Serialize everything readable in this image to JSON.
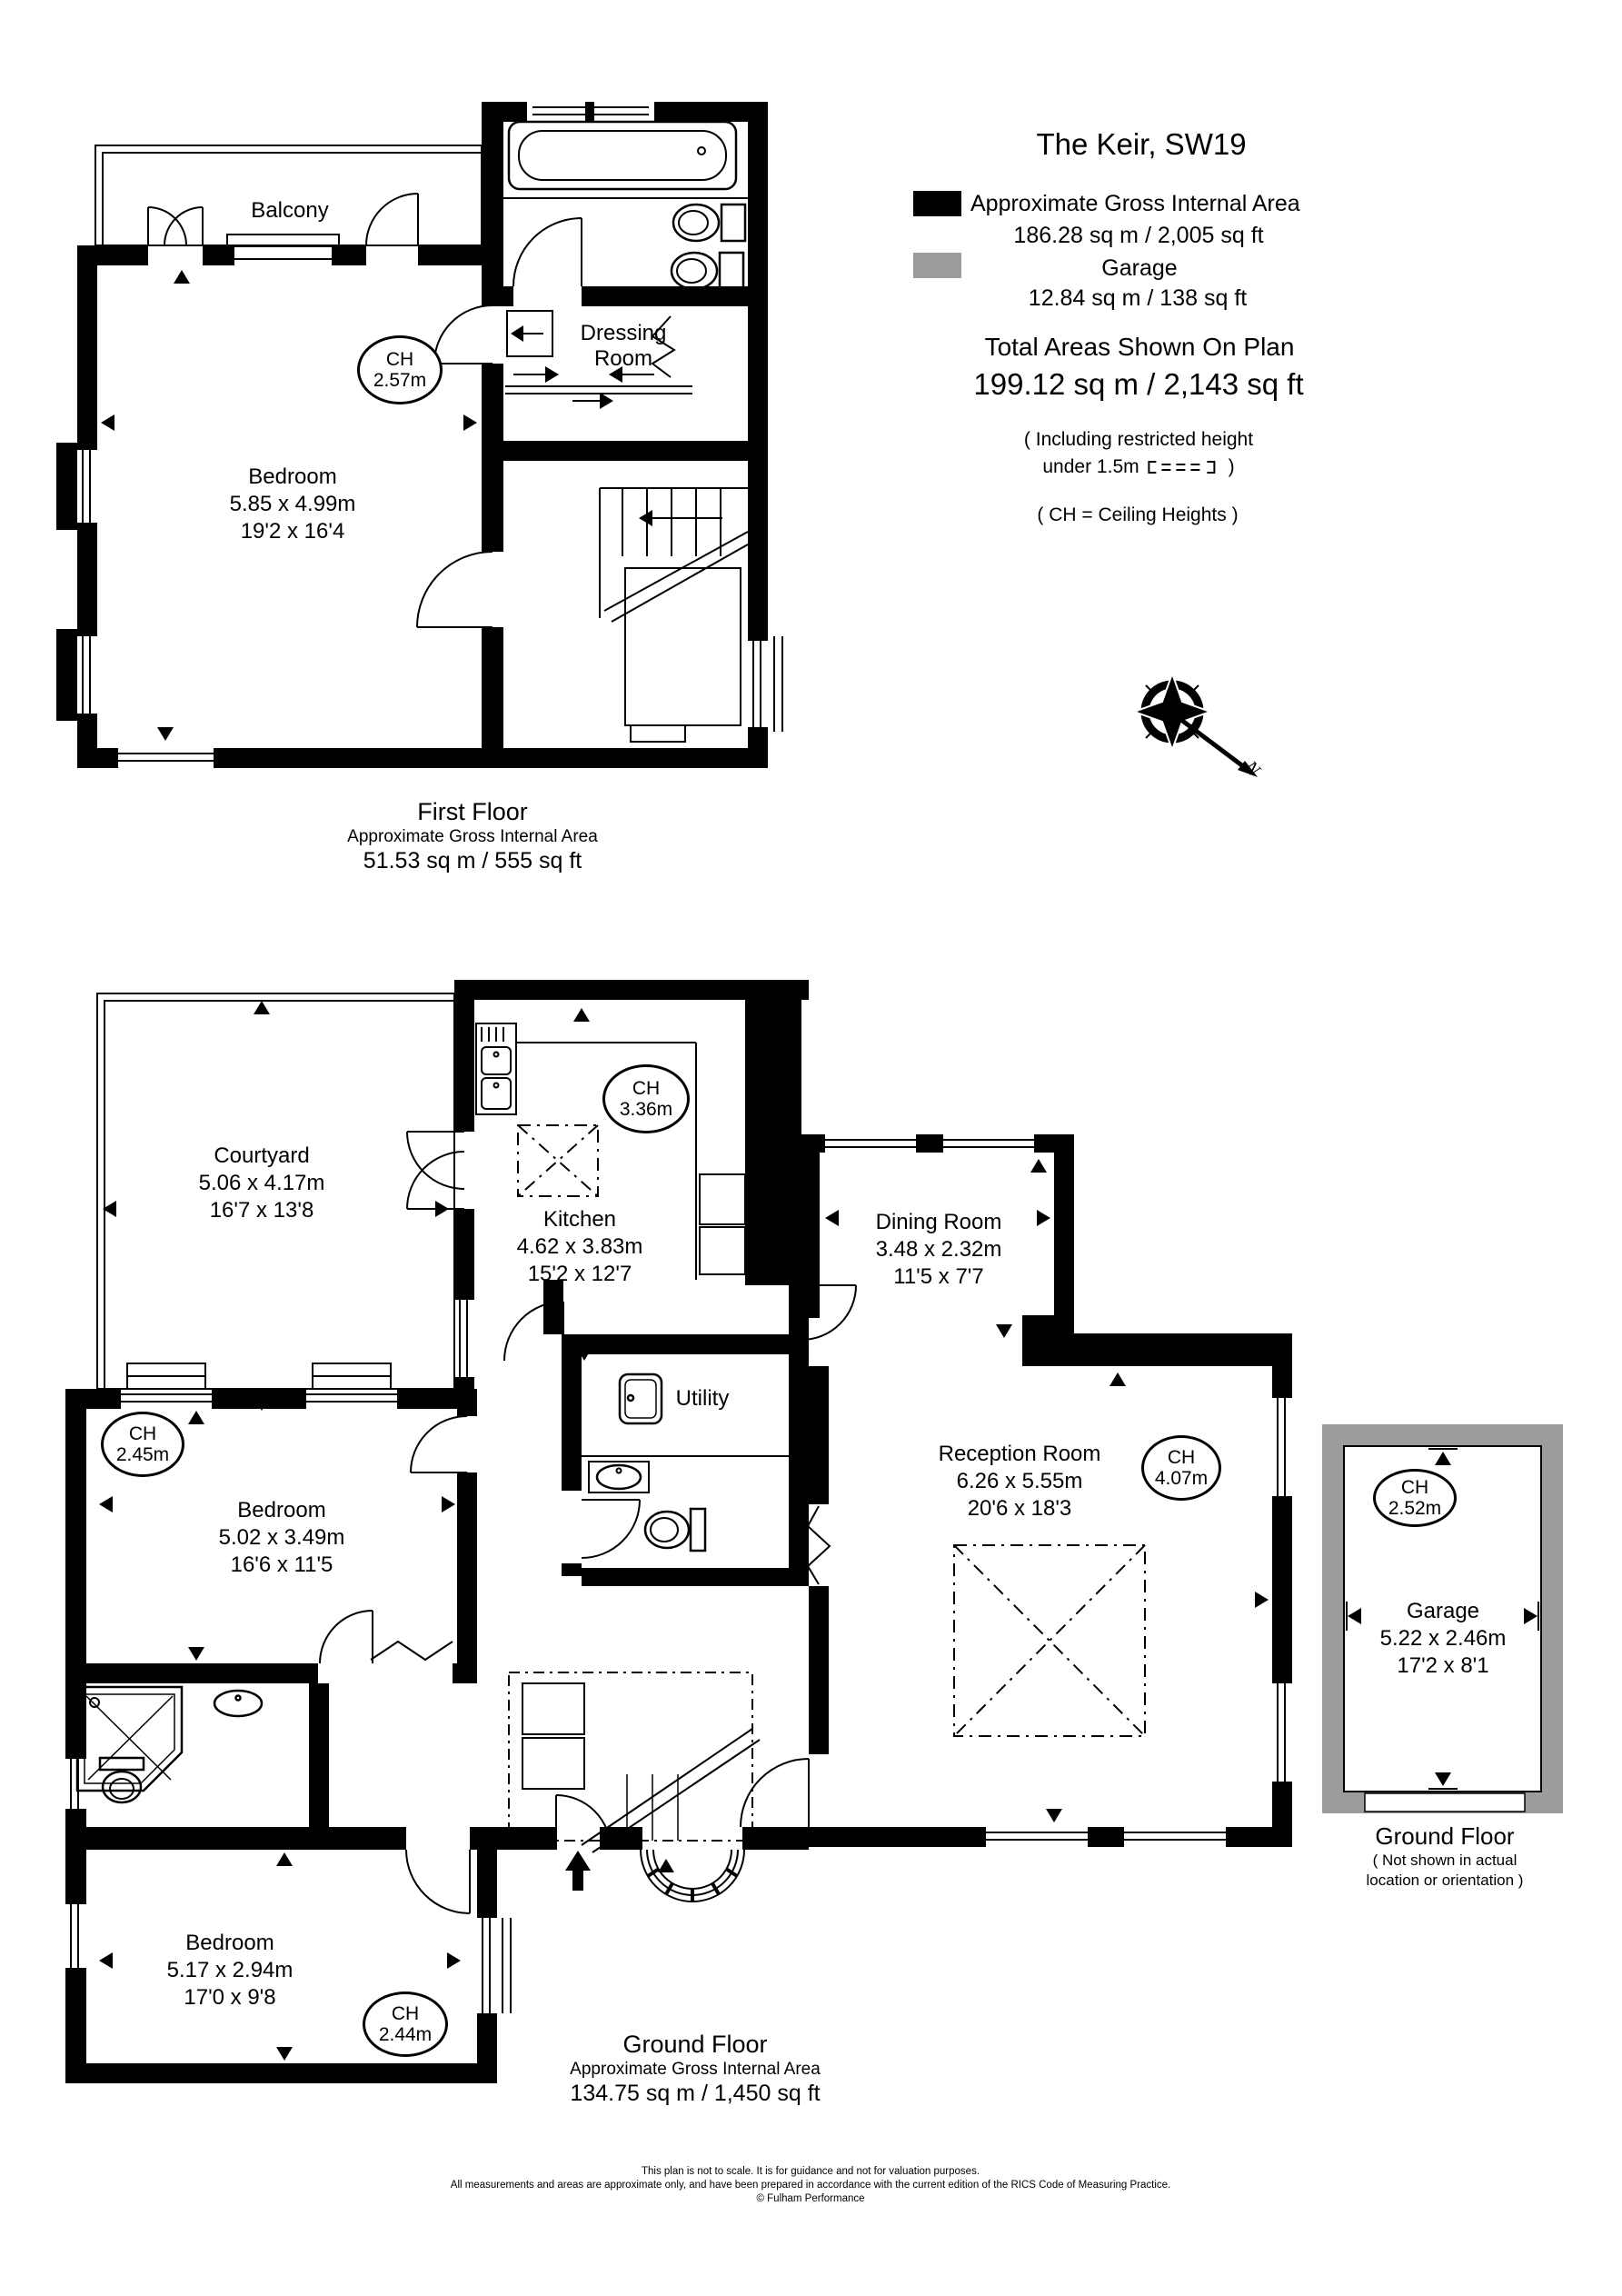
{
  "title": "The Keir, SW19",
  "legend": {
    "internal_color": "#000000",
    "garage_color": "#9c9c9c",
    "internal_label": "Approximate Gross Internal Area",
    "internal_value": "186.28 sq m  /  2,005 sq ft",
    "garage_label": "Garage",
    "garage_value": "12.84 sq m  /  138 sq ft"
  },
  "totals": {
    "label": "Total Areas Shown On Plan",
    "value": "199.12 sq m  /  2,143 sq ft",
    "restricted_line1": "( Including restricted height",
    "restricted_line2_text": "under 1.5m",
    "restricted_line2_close": ")",
    "ch_note": "( CH = Ceiling Heights )"
  },
  "compass": {
    "north_label": "N"
  },
  "first_floor": {
    "caption_title": "First Floor",
    "caption_subtitle": "Approximate Gross Internal Area",
    "caption_area": "51.53 sq m  /  555 sq ft",
    "balcony": {
      "name": "Balcony"
    },
    "bedroom": {
      "name": "Bedroom",
      "metric": "5.85 x 4.99m",
      "imperial": "19'2 x 16'4"
    },
    "bedroom_ch": {
      "label": "CH",
      "value": "2.57m"
    },
    "dressing_room": {
      "line1": "Dressing",
      "line2": "Room"
    }
  },
  "ground_floor": {
    "caption_title": "Ground Floor",
    "caption_subtitle": "Approximate Gross Internal Area",
    "caption_area": "134.75 sq m  /  1,450 sq ft",
    "courtyard": {
      "name": "Courtyard",
      "metric": "5.06 x 4.17m",
      "imperial": "16'7 x 13'8"
    },
    "kitchen": {
      "name": "Kitchen",
      "metric": "4.62 x 3.83m",
      "imperial": "15'2 x 12'7"
    },
    "kitchen_ch": {
      "label": "CH",
      "value": "3.36m"
    },
    "dining_room": {
      "name": "Dining Room",
      "metric": "3.48 x 2.32m",
      "imperial": "11'5 x 7'7"
    },
    "reception_room": {
      "name": "Reception Room",
      "metric": "6.26 x 5.55m",
      "imperial": "20'6 x 18'3"
    },
    "reception_ch": {
      "label": "CH",
      "value": "4.07m"
    },
    "utility": {
      "name": "Utility"
    },
    "bedroom_middle": {
      "name": "Bedroom",
      "metric": "5.02 x 3.49m",
      "imperial": "16'6 x 11'5"
    },
    "bedroom_middle_ch": {
      "label": "CH",
      "value": "2.45m"
    },
    "bedroom_bottom": {
      "name": "Bedroom",
      "metric": "5.17 x 2.94m",
      "imperial": "17'0 x 9'8"
    },
    "bedroom_bottom_ch": {
      "label": "CH",
      "value": "2.44m"
    }
  },
  "garage": {
    "name": "Garage",
    "metric": "5.22 x 2.46m",
    "imperial": "17'2 x 8'1",
    "ch": {
      "label": "CH",
      "value": "2.52m"
    },
    "caption_title": "Ground Floor",
    "caption_note_line1": "( Not shown in actual",
    "caption_note_line2": "location or orientation )"
  },
  "footer": {
    "line1": "This plan is not to scale. It is for guidance and not for valuation purposes.",
    "line2": "All measurements and areas are approximate only, and have been prepared in accordance with the current edition of the RICS Code of Measuring Practice.",
    "line3": "© Fulham Performance"
  }
}
